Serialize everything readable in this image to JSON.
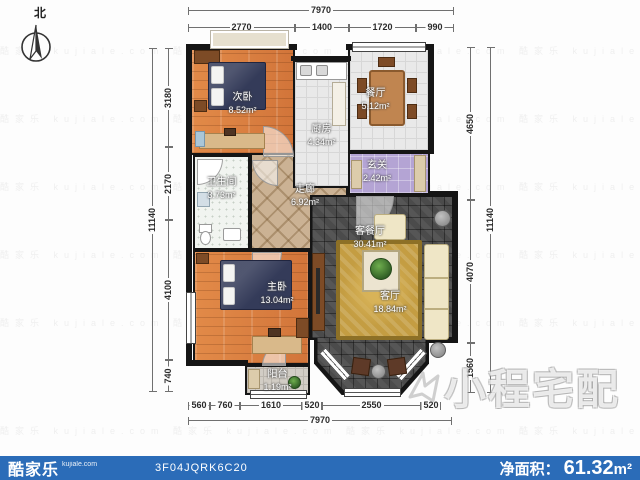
{
  "compass": {
    "north_label": "北"
  },
  "watermark": {
    "big_text": "小程宅配",
    "row": "酷家乐 kujiale.com      酷家乐 kujiale.com      酷家乐 kujiale.com      酷家乐 kujiale.com"
  },
  "dimensions": {
    "top": {
      "total": "7970",
      "segments": [
        "2770",
        "1400",
        "1720",
        "990"
      ]
    },
    "bottom": {
      "total": "7970",
      "segments": [
        "560",
        "760",
        "1610",
        "520",
        "2550",
        "520"
      ]
    },
    "left": {
      "total": "11140",
      "segments": [
        "3180",
        "2170",
        "4100",
        "740"
      ]
    },
    "right": {
      "total": "11140",
      "segments": [
        "4650",
        "4070",
        "1560"
      ]
    }
  },
  "rooms": [
    {
      "name": "次卧",
      "area": "8.52m²"
    },
    {
      "name": "厨房",
      "area": "4.34m²"
    },
    {
      "name": "餐厅",
      "area": "5.12m²"
    },
    {
      "name": "玄关",
      "area": "2.42m²"
    },
    {
      "name": "卫生间",
      "area": "3.73m²"
    },
    {
      "name": "走廊",
      "area": "6.92m²"
    },
    {
      "name": "客餐厅",
      "area": "30.41m²"
    },
    {
      "name": "客厅",
      "area": "18.84m²"
    },
    {
      "name": "主卧",
      "area": "13.04m²"
    },
    {
      "name": "阳台",
      "area": "1.19m²"
    }
  ],
  "footer": {
    "brand": "酷家乐",
    "brand_sub": "kujiale.com",
    "plan_id": "3F04JQRK6C20",
    "net_area_label": "净面积：",
    "net_area_value": "61.32",
    "net_area_unit": "m²",
    "bar_color": "#2b6cb8"
  }
}
